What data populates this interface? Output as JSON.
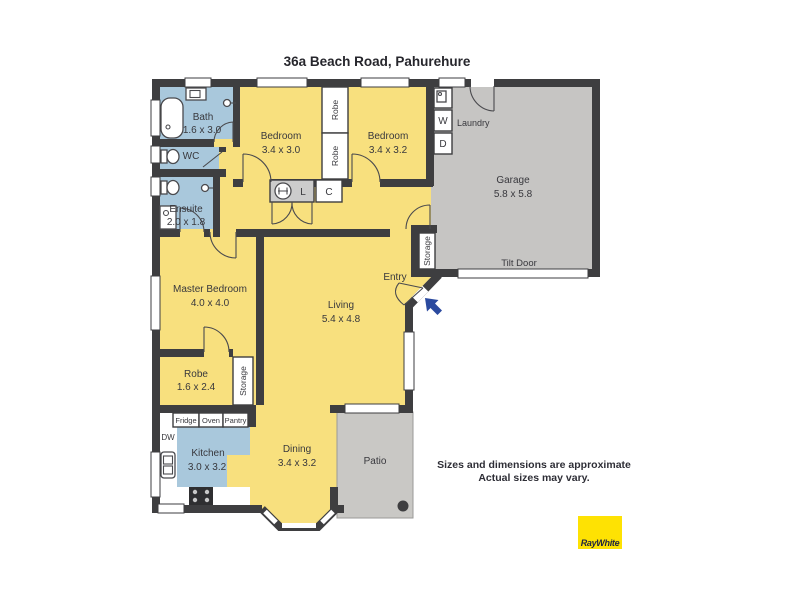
{
  "page": {
    "title": "36a Beach Road, Pahurehure"
  },
  "disclaimer": {
    "line1": "Sizes and dimensions are approximate",
    "line2": "Actual sizes may vary."
  },
  "brand": {
    "name": "RayWhite"
  },
  "rooms": {
    "bath": {
      "name": "Bath",
      "dims": "1.6 x 3.0"
    },
    "wc": {
      "name": "WC"
    },
    "ensuite": {
      "name": "Ensuite",
      "dims": "2.0 x 1.8"
    },
    "bedroom1": {
      "name": "Bedroom",
      "dims": "3.4 x 3.0"
    },
    "bedroom2": {
      "name": "Bedroom",
      "dims": "3.4 x 3.2"
    },
    "laundry": {
      "name": "Laundry"
    },
    "garage": {
      "name": "Garage",
      "dims": "5.8 x 5.8",
      "door": "Tilt Door"
    },
    "master": {
      "name": "Master Bedroom",
      "dims": "4.0 x 4.0"
    },
    "living": {
      "name": "Living",
      "dims": "5.4 x 4.8"
    },
    "entry": {
      "name": "Entry"
    },
    "robe": {
      "name": "Robe",
      "dims": "1.6 x 2.4"
    },
    "kitchen": {
      "name": "Kitchen",
      "dims": "3.0 x 3.2"
    },
    "dining": {
      "name": "Dining",
      "dims": "3.4 x 3.2"
    },
    "patio": {
      "name": "Patio"
    }
  },
  "fixtures": {
    "robe_closet": "Robe",
    "storage": "Storage",
    "linen": "L",
    "cupboard": "C",
    "washer": "W",
    "dryer": "D",
    "dishwasher": "DW",
    "fridge": "Fridge",
    "oven": "Oven",
    "pantry": "Pantry"
  },
  "colors": {
    "room_yellow": "#F8E07E",
    "wet_room_blue": "#A9C8DC",
    "garage_gray": "#C6C5C3",
    "wall": "#3E3E40",
    "entry_arrow": "#2B4A9F",
    "brand_yellow": "#FEE203",
    "brand_text": "#1F2440"
  }
}
